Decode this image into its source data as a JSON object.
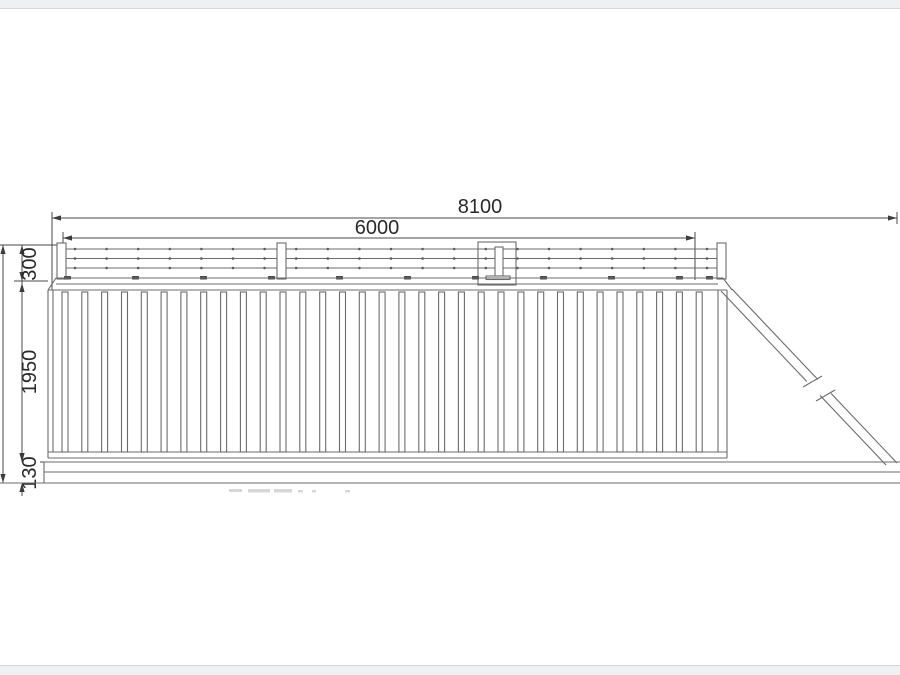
{
  "window": {
    "background": "#ffffff",
    "chrome_strip_color": "#eef0f2"
  },
  "drawing": {
    "title": "cantilever-sliding-gate-elevation",
    "dimensions": {
      "width_total": "8100",
      "width_inner": "6000",
      "height_top_section": "300",
      "height_panel": "1950",
      "height_bottom_rail": "130"
    },
    "colors": {
      "drawing_line": "#6b6b6b",
      "dimension_line": "#4a4a4a",
      "dimension_text": "#2a2a2a",
      "clamp": "#4a4a4a"
    }
  }
}
